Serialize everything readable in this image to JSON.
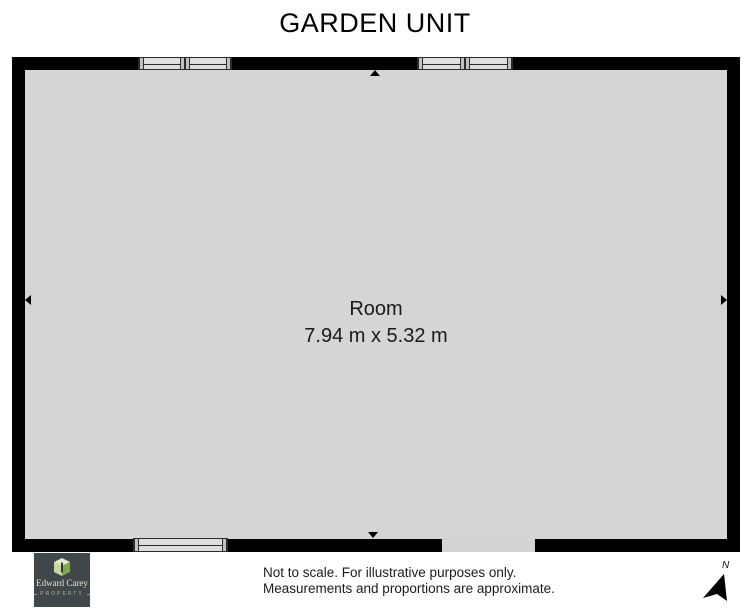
{
  "title": "GARDEN UNIT",
  "room": {
    "name": "Room",
    "dimensions": "7.94 m x 5.32 m"
  },
  "logo": {
    "name": "Edward Carey",
    "tagline": "PROPERTY"
  },
  "footer": {
    "disclaimer_line1": "Not to scale. For illustrative purposes only.",
    "disclaimer_line2": "Measurements and proportions are approximate.",
    "compass_label": "N"
  },
  "colors": {
    "page_bg": "#ffffff",
    "wall": "#000000",
    "floor": "#d5d5d5",
    "window_fill": "#dedede",
    "window_post": "#c2c2c2",
    "window_frame": "#2b2b2b",
    "door": "#d3d3d3",
    "text": "#1a1a1a",
    "logo_bg": "#40474a",
    "logo_text": "#eae4d0",
    "logo_green_light": "#e2ead0",
    "logo_green_mid": "#c6d89a",
    "logo_green_dark": "#7fa74c"
  }
}
